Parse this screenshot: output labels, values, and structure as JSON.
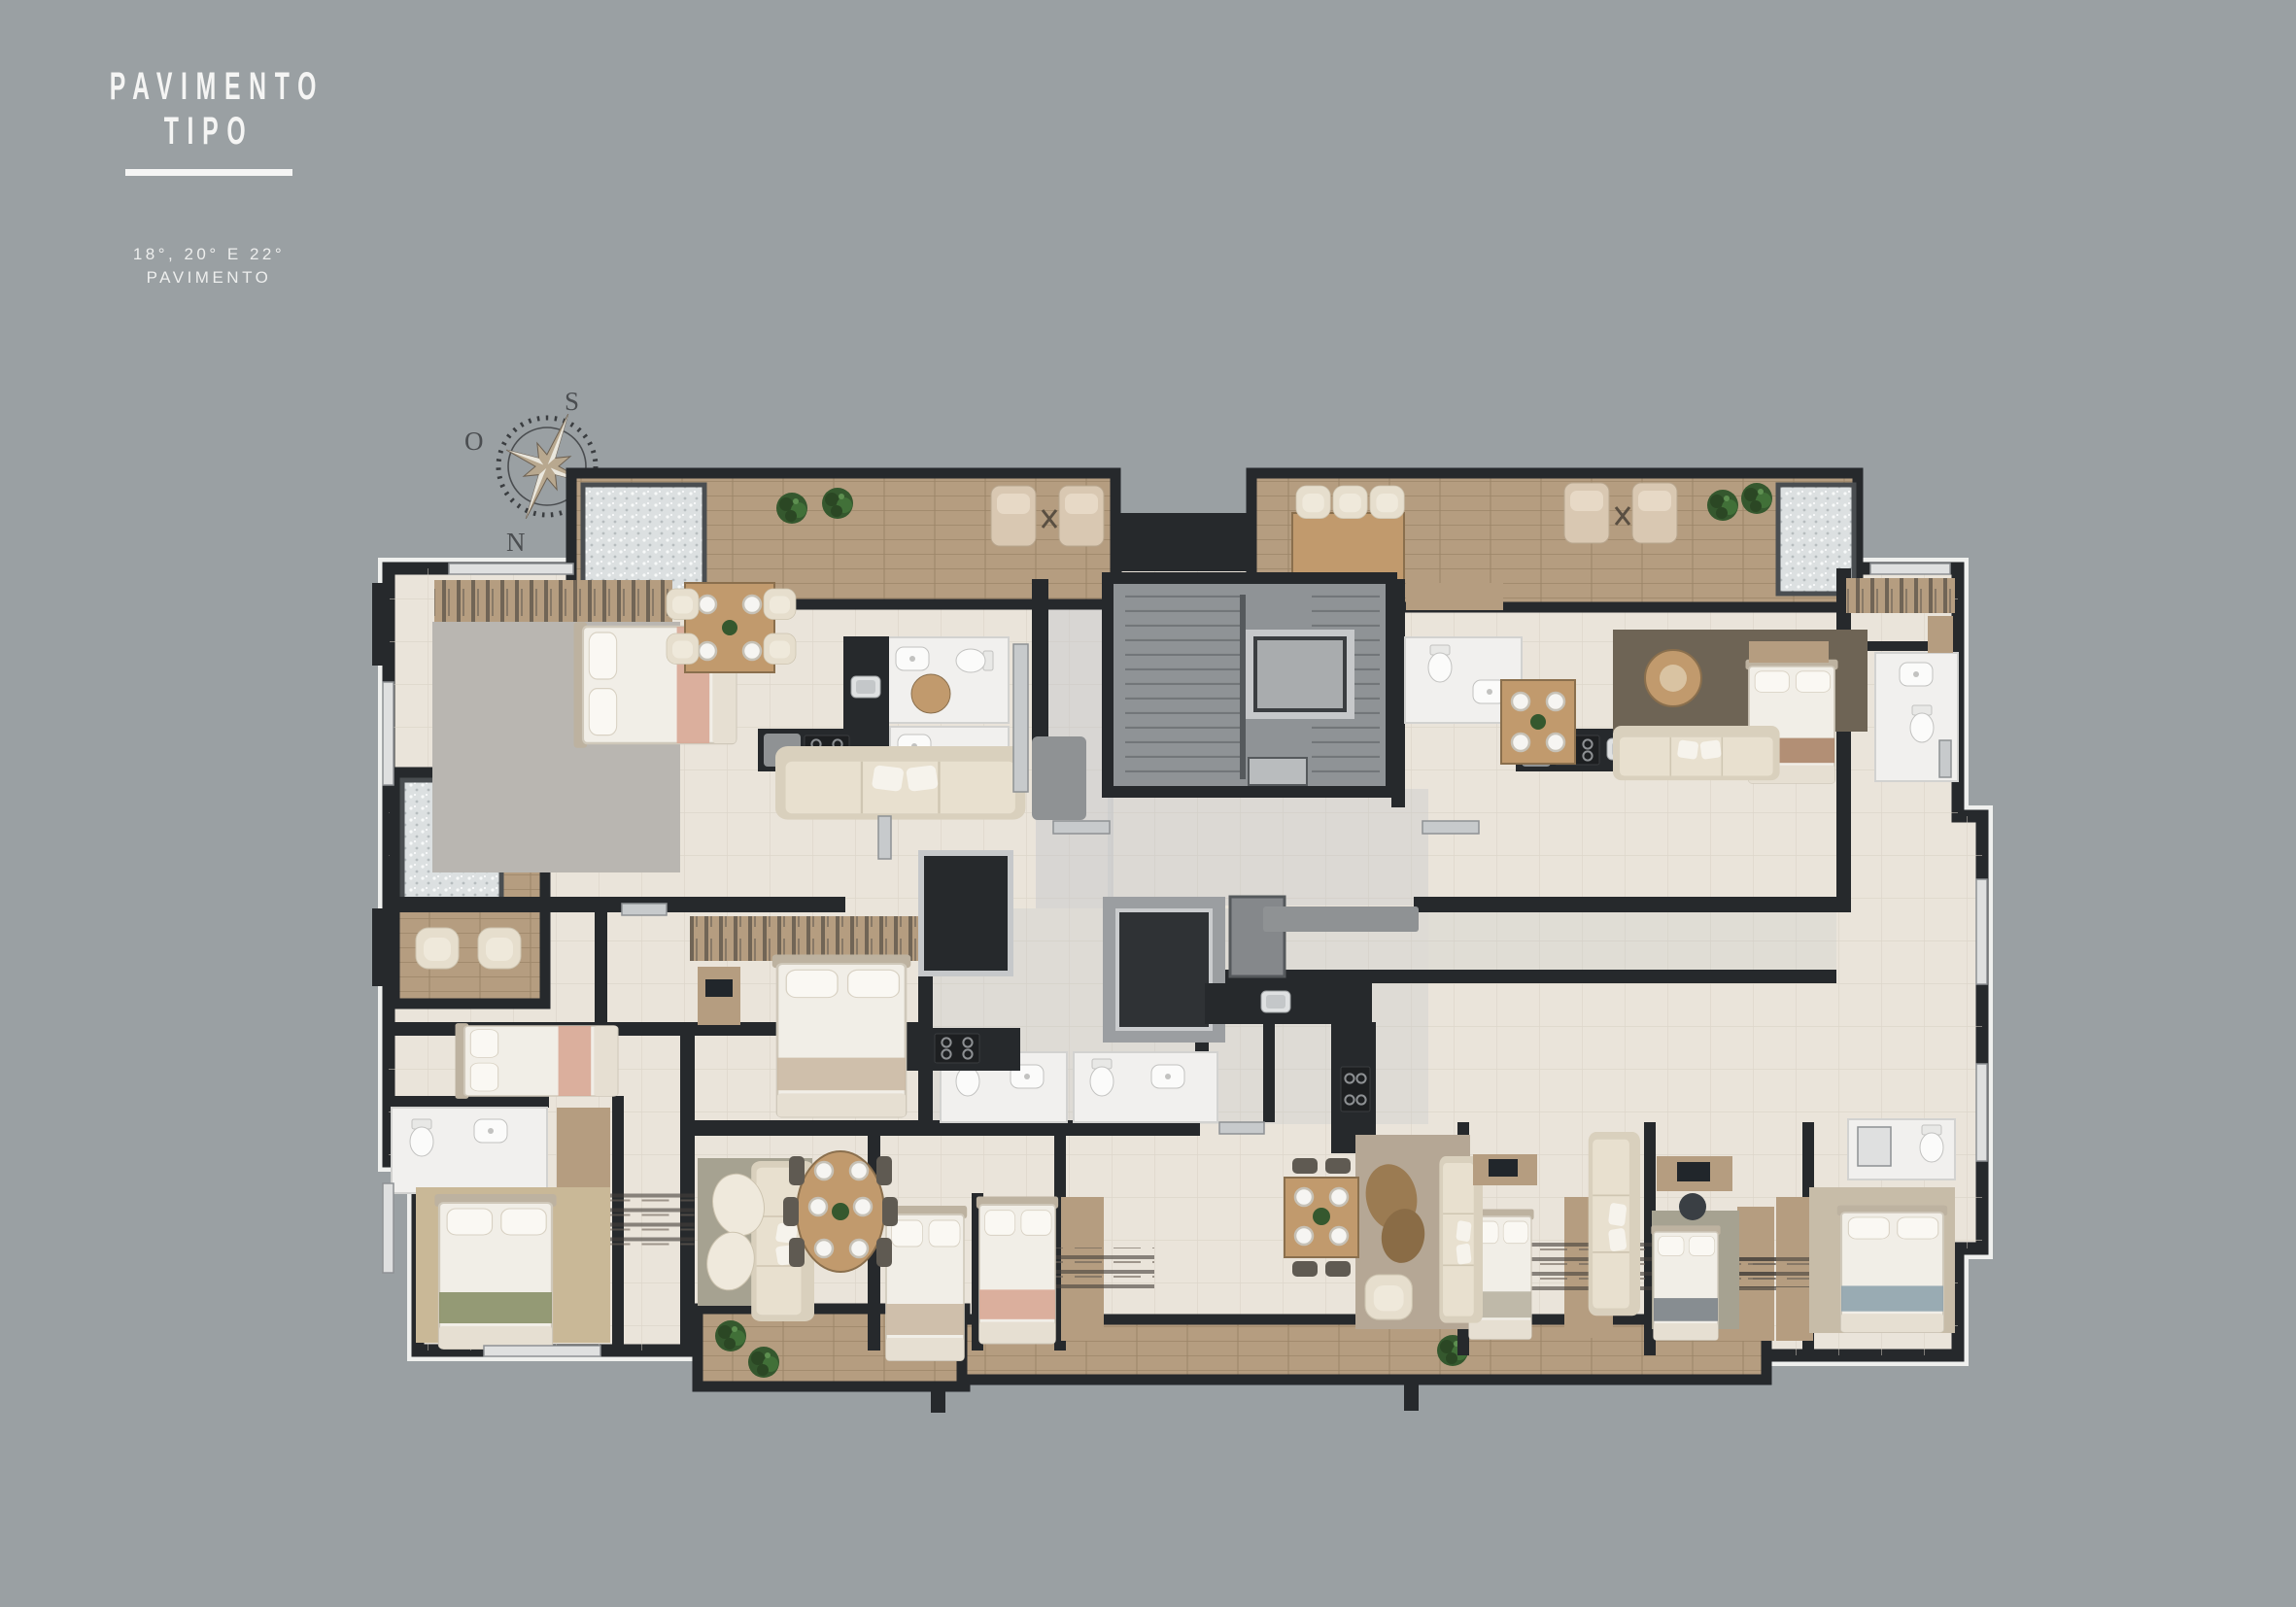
{
  "header": {
    "title_line1": "PAVIMENTO",
    "title_line2": "TIPO",
    "subtitle_line1": "18°, 20° E 22°",
    "subtitle_line2": "PAVIMENTO"
  },
  "compass": {
    "south": "S",
    "west": "O",
    "east": "L",
    "north": "N"
  },
  "colors": {
    "bg": "#9aa0a3",
    "wall": "#26292c",
    "floor": "#eae4da",
    "wood-deck": "#b59d80",
    "stair-core": "#8f9396",
    "bathroom": "#f1f0ee",
    "accent-pink": "#d8a795",
    "accent-green": "#8a9068",
    "accent-blue": "#8fa3ad",
    "plant": "#35582e",
    "title-text": "#f5f5f4",
    "compass-text": "#4b4e51"
  }
}
